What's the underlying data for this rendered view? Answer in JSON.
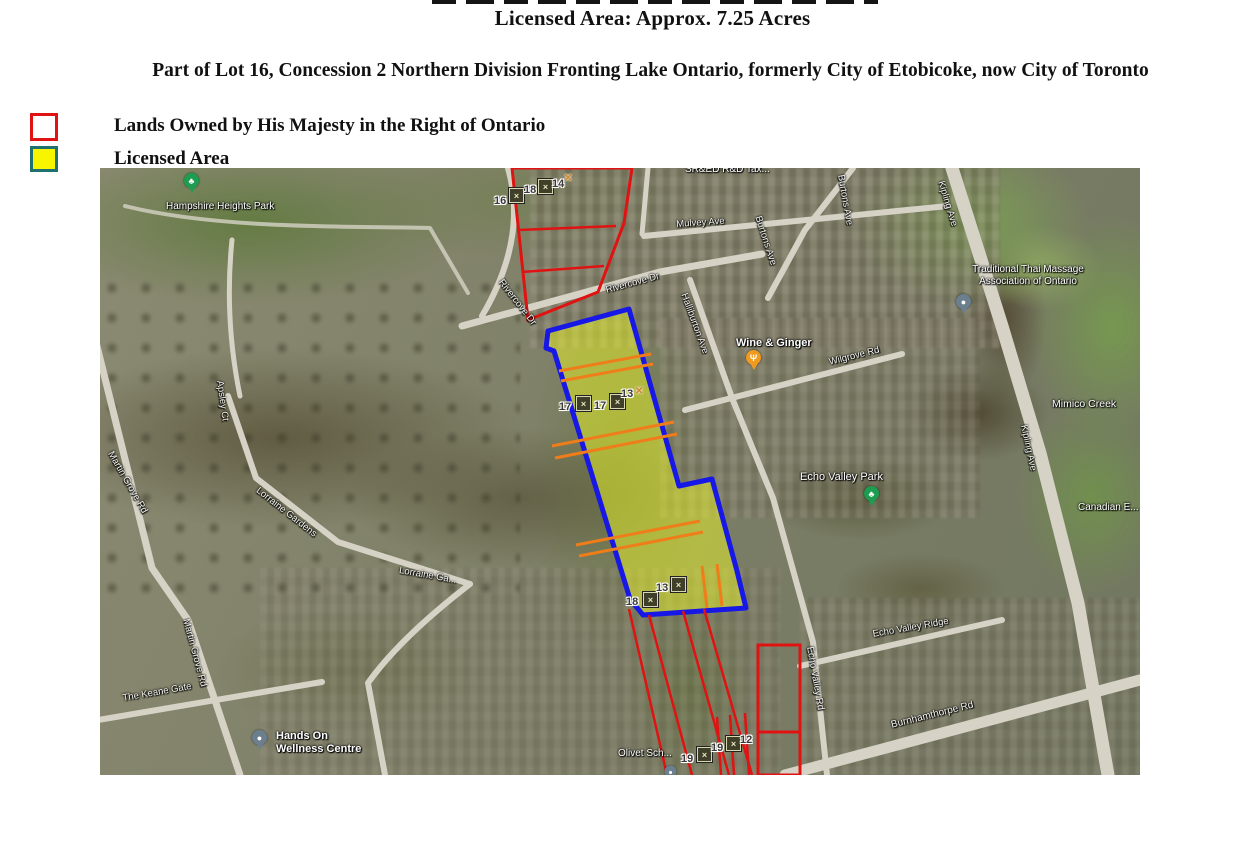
{
  "document": {
    "title_line": "Licensed Area: Approx. 7.25 Acres",
    "heading": "Part of Lot 16, Concession 2 Northern Division Fronting Lake Ontario, formerly City of Etobicoke, now City of Toronto"
  },
  "legend": {
    "items": [
      {
        "label": "Lands Owned by His Majesty in the Right of Ontario",
        "swatch_fill": "#ffffff",
        "swatch_border": "#e01212"
      },
      {
        "label": "Licensed Area",
        "swatch_fill": "#f8f500",
        "swatch_border": "#1f7070"
      }
    ]
  },
  "map": {
    "type": "satellite",
    "overlay_colors": {
      "crown_lands_outline": "#e01212",
      "licensed_area_outline": "#1717e6",
      "licensed_area_fill": "#ebf528",
      "internal_parcel_lines": "#ef7d1a"
    },
    "labels": [
      {
        "text": "Hampshire Heights Park"
      },
      {
        "text": "SR&ED R&D Tax..."
      },
      {
        "text": "Mulvey Ave"
      },
      {
        "text": "Burtons Ave"
      },
      {
        "text": "Burtons Ave"
      },
      {
        "text": "Kipling Ave"
      },
      {
        "text": "Traditional Thai Massage\nAssociation of Ontario"
      },
      {
        "text": "Wine & Ginger"
      },
      {
        "text": "Wilgrove Rd"
      },
      {
        "text": "Halliburton Ave"
      },
      {
        "text": "Rivercove Dr"
      },
      {
        "text": "Rivercove Dr"
      },
      {
        "text": "Mimico Creek"
      },
      {
        "text": "Echo Valley Park"
      },
      {
        "text": "Canadian E..."
      },
      {
        "text": "Echo Valley Ridge"
      },
      {
        "text": "Echo Valley Rd"
      },
      {
        "text": "Burnhamthorpe Rd"
      },
      {
        "text": "Olivet Sch..."
      },
      {
        "text": "Hands On\nWellness Centre"
      },
      {
        "text": "The Keane Gate"
      },
      {
        "text": "Martin Grove Rd"
      },
      {
        "text": "Martin Grove Rd"
      },
      {
        "text": "Lorraine Gardens"
      },
      {
        "text": "Lorraine Ga..."
      },
      {
        "text": "Apsley Ct"
      },
      {
        "text": "Kipling Ave"
      }
    ],
    "markers": [
      "16",
      "18",
      "14",
      "17",
      "17",
      "13",
      "18",
      "13",
      "19",
      "19",
      "12"
    ]
  }
}
